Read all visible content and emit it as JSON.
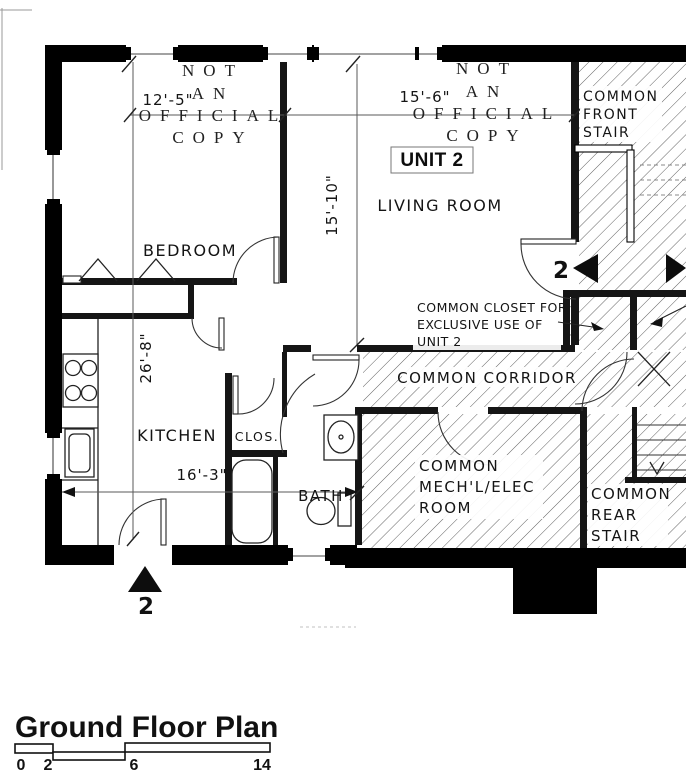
{
  "watermark": {
    "line1": "NOT",
    "line2": "AN",
    "line3": "OFFICIAL",
    "line4": "COPY"
  },
  "unit": {
    "label": "UNIT 2"
  },
  "rooms": {
    "bedroom": "BEDROOM",
    "living_room": "LIVING ROOM",
    "kitchen": "KITCHEN",
    "closet": "CLOS.",
    "bath": "BATH",
    "corridor": "COMMON CORRIDOR",
    "front_stair": [
      "COMMON",
      "FRONT",
      "STAIR"
    ],
    "mech_room": [
      "COMMON",
      "MECH'L/ELEC",
      "ROOM"
    ],
    "rear_stair": [
      "COMMON",
      "REAR",
      "STAIR"
    ]
  },
  "dims": {
    "bedroom_width": "12'-5\"",
    "living_width": "15'-6\"",
    "living_depth": "15'-10\"",
    "unit_depth": "26'-8\"",
    "kitchen_width": "16'-3\""
  },
  "note": {
    "line1": "COMMON CLOSET FOR",
    "line2": "EXCLUSIVE USE OF",
    "line3": "UNIT 2"
  },
  "markers": {
    "unit_number": "2"
  },
  "title": {
    "text": "Ground Floor Plan"
  },
  "scale": {
    "labels": [
      "0",
      "2",
      "6",
      "14"
    ]
  },
  "colors": {
    "ink": "#111111",
    "wall": "#000000",
    "hatch": "#3a3a3a",
    "dim": "#5a5a5a"
  }
}
